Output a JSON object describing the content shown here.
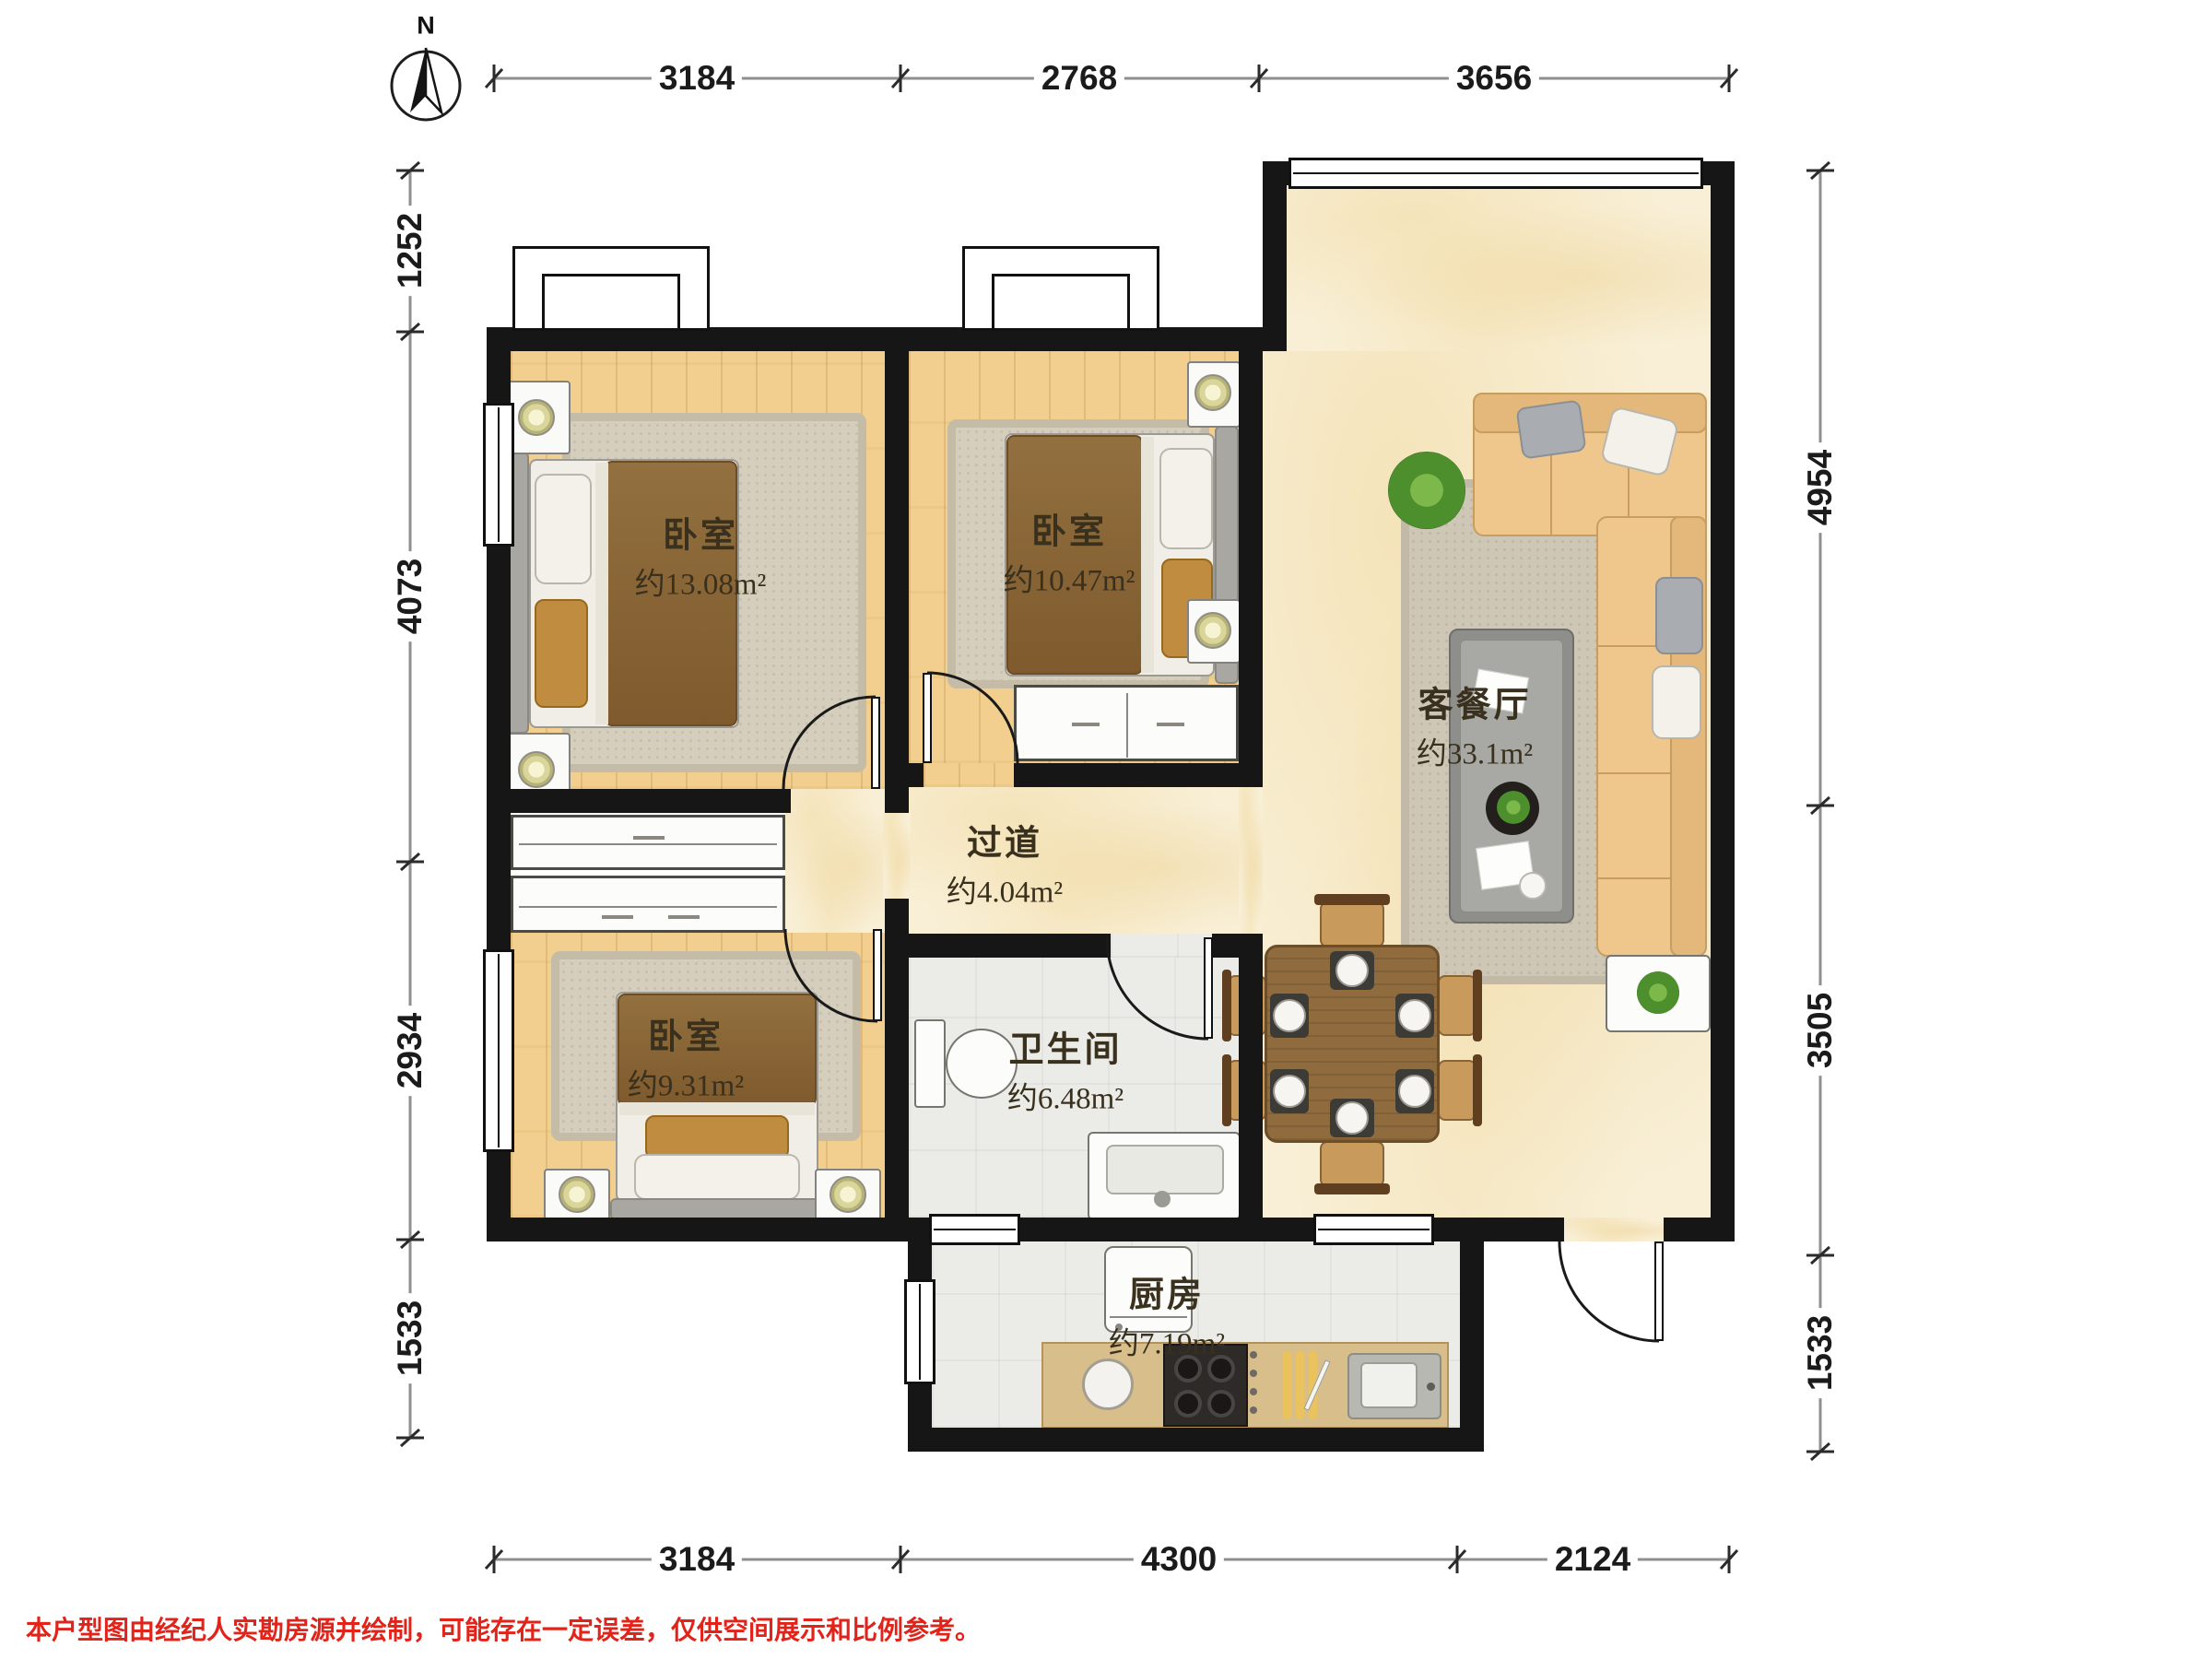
{
  "compass": {
    "label": "N"
  },
  "rooms": {
    "bedroom1": {
      "name": "卧室",
      "area": "约13.08m²"
    },
    "bedroom2": {
      "name": "卧室",
      "area": "约10.47m²"
    },
    "bedroom3": {
      "name": "卧室",
      "area": "约9.31m²"
    },
    "living": {
      "name": "客餐厅",
      "area": "约33.1m²"
    },
    "hallway": {
      "name": "过道",
      "area": "约4.04m²"
    },
    "bathroom": {
      "name": "卫生间",
      "area": "约6.48m²"
    },
    "kitchen": {
      "name": "厨房",
      "area": "约7.19m²"
    }
  },
  "dimensions": {
    "top": [
      "3184",
      "2768",
      "3656"
    ],
    "left": [
      "1252",
      "4073",
      "2934",
      "1533"
    ],
    "right": [
      "4954",
      "3505",
      "1533"
    ],
    "bottom": [
      "3184",
      "4300",
      "2124"
    ]
  },
  "disclaimer": "本户型图由经纪人实勘房源并绘制，可能存在一定误差，仅供空间展示和比例参考。",
  "colors": {
    "wall": "#161616",
    "wood_floor": "#F2CF8E",
    "marble_floor": "#F8EFD6",
    "tile_floor": "#EBEBE8",
    "sofa": "#EFC78C",
    "dining_table": "#8F6B3E",
    "disclaimer_red": "#E2231A"
  }
}
